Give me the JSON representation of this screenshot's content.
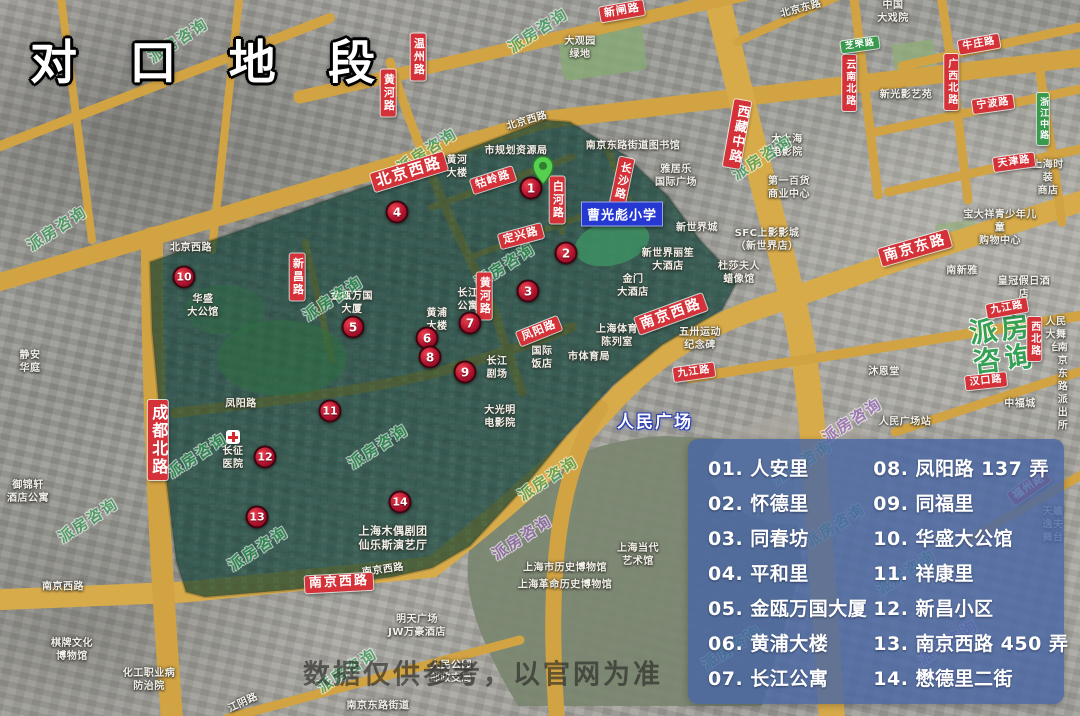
{
  "title": "对 口 地 段",
  "watermark": "派房咨询",
  "watermark_big": {
    "line1": "派房",
    "line2": "咨询"
  },
  "disclaimer": "数据仅供参考，以官网为准",
  "labels_blue": {
    "school": "曹光彪小学",
    "square": "人民广场"
  },
  "legend": {
    "items": [
      "01. 人安里",
      "02. 怀德里",
      "03. 同春坊",
      "04. 平和里",
      "05. 金瓯万国大厦",
      "06. 黄浦大楼",
      "07. 长江公寓",
      "08. 凤阳路 137 弄",
      "09. 同福里",
      "10. 华盛大公馆",
      "11. 祥康里",
      "12. 新昌小区",
      "13. 南京西路 450 弄",
      "14. 懋德里二街"
    ]
  },
  "markers": [
    "1",
    "2",
    "3",
    "4",
    "5",
    "6",
    "7",
    "8",
    "9",
    "10",
    "11",
    "12",
    "13",
    "14"
  ],
  "roads_red": [
    "新闸路",
    "温州路",
    "黄河路",
    "北京西路",
    "牯岭路",
    "白河路",
    "长沙路",
    "定兴路",
    "新昌路",
    "黄河路",
    "凤阳路",
    "南京西路",
    "南京东路",
    "成都北路",
    "南京西路",
    "西藏中路",
    "牛庄路",
    "广西北路",
    "云南北路",
    "宁波路",
    "天津路",
    "九江路",
    "西北路",
    "汉口路",
    "九江路",
    "福州路"
  ],
  "roads_green": [
    "芝罘路",
    "浙江中路"
  ],
  "base_labels": [
    "市规划资源局",
    "黄河\n大楼",
    "南京东路街道图书馆",
    "雅居乐\n国际广场",
    "大观园\n绿地",
    "北京西路",
    "北京西路",
    "北京东路",
    "中国\n大戏院",
    "新光影艺苑",
    "大上海\n电影院",
    "第一百货\n商业中心",
    "上海时装\n商店",
    "宝大祥青少年儿童\n购物中心",
    "南新雅",
    "皇冠假日酒店",
    "新世界城",
    "SFC上影影城\n（新世界店）",
    "新世界丽笙\n大酒店",
    "杜莎夫人\n蜡像馆",
    "金门\n大酒店",
    "五卅运动\n纪念碑",
    "上海体育\n陈列室",
    "市体育局",
    "国际\n饭店",
    "长江\n剧场",
    "大光明\n电影院",
    "长江\n公寓",
    "黄浦\n大楼",
    "金瓯万国\n大厦",
    "华盛\n大公馆",
    "凤阳路",
    "长征\n医院",
    "上海木偶剧团\n仙乐斯演艺厅",
    "上海市历史博物馆",
    "上海革命历史博物馆",
    "明天广场\nJW万豪酒店",
    "人民公园\n邮政支局",
    "南京东路街道",
    "江阴路",
    "南京西路",
    "棋牌文化\n博物馆",
    "化工职业病\n防治院",
    "御锦轩\n酒店公寓",
    "静安\n华庭",
    "上海当代\n艺术馆",
    "人民广场站",
    "沐恩堂",
    "人民\n大舞台",
    "南京东路\n派出所",
    "中福城",
    "天蟾逸夫舞台",
    "南京西路"
  ],
  "colors": {
    "road": "#d2a342",
    "district_overlay": "#0e3e34",
    "legend_bg": "#4866a8",
    "marker_red": "#b3122e",
    "label_red": "#d43238",
    "watermark_green": "#2ba14f",
    "school_blue": "#2538d2"
  }
}
